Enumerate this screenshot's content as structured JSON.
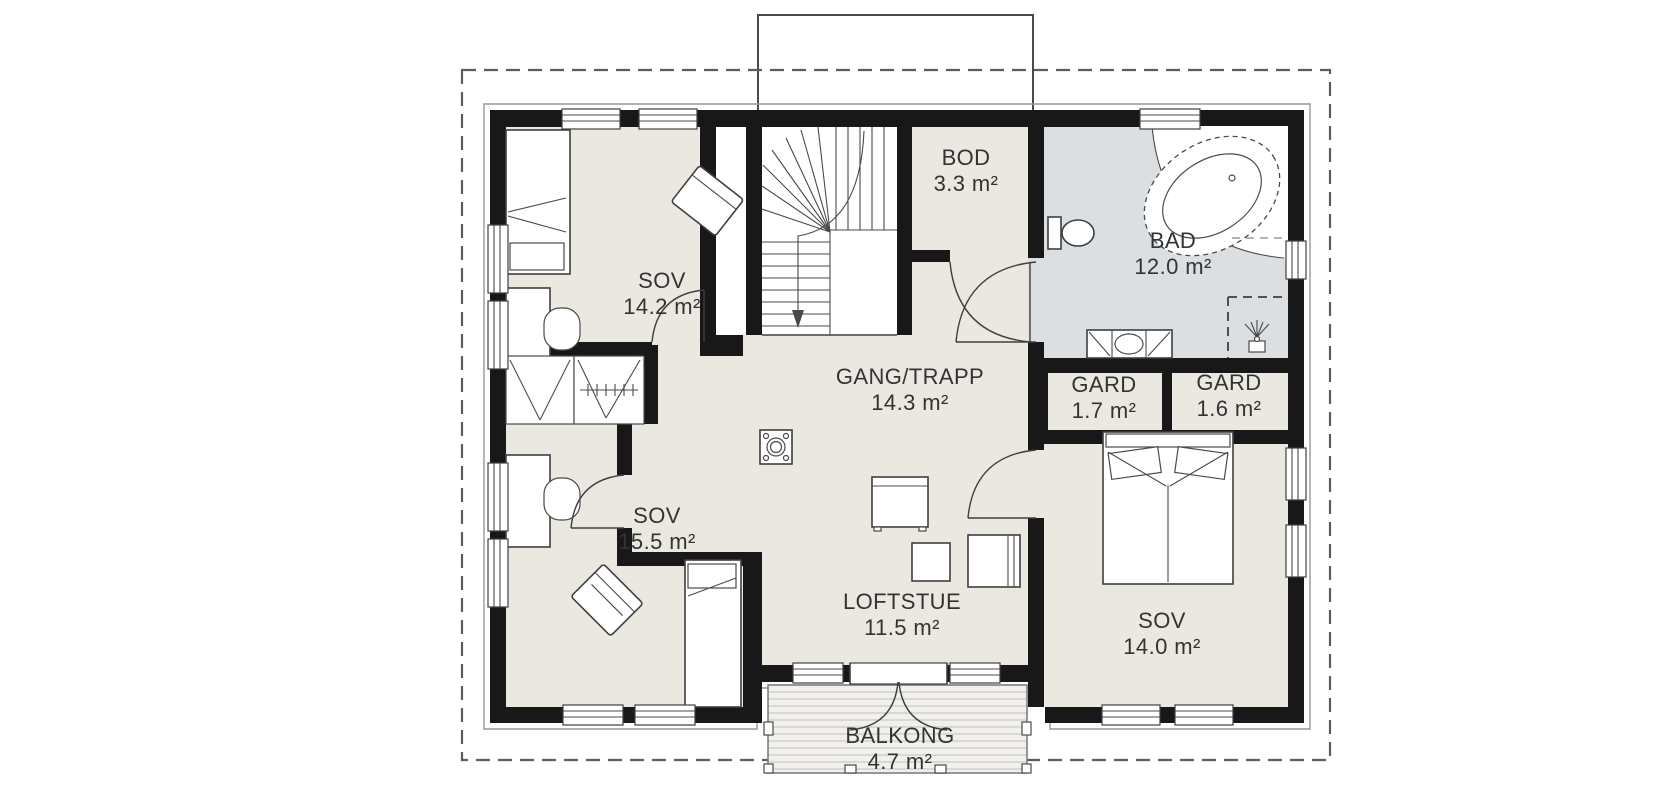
{
  "floorplan": {
    "rooms": [
      {
        "id": "sov1",
        "name": "SOV",
        "area": "14.2 m²"
      },
      {
        "id": "bod",
        "name": "BOD",
        "area": "3.3 m²"
      },
      {
        "id": "bad",
        "name": "BAD",
        "area": "12.0 m²"
      },
      {
        "id": "gang",
        "name": "GANG/TRAPP",
        "area": "14.3 m²"
      },
      {
        "id": "gard1",
        "name": "GARD",
        "area": "1.7 m²"
      },
      {
        "id": "gard2",
        "name": "GARD",
        "area": "1.6 m²"
      },
      {
        "id": "sov2",
        "name": "SOV",
        "area": "15.5 m²"
      },
      {
        "id": "loftstue",
        "name": "LOFTSTUE",
        "area": "11.5 m²"
      },
      {
        "id": "sov3",
        "name": "SOV",
        "area": "14.0 m²"
      },
      {
        "id": "balkong",
        "name": "BALKONG",
        "area": "4.7 m²"
      }
    ],
    "colors": {
      "wall": "#181818",
      "floor": "#eae8e1",
      "bathroom_floor": "#dcdfe1",
      "deck": "#f1f0ec",
      "text": "#333333"
    }
  }
}
